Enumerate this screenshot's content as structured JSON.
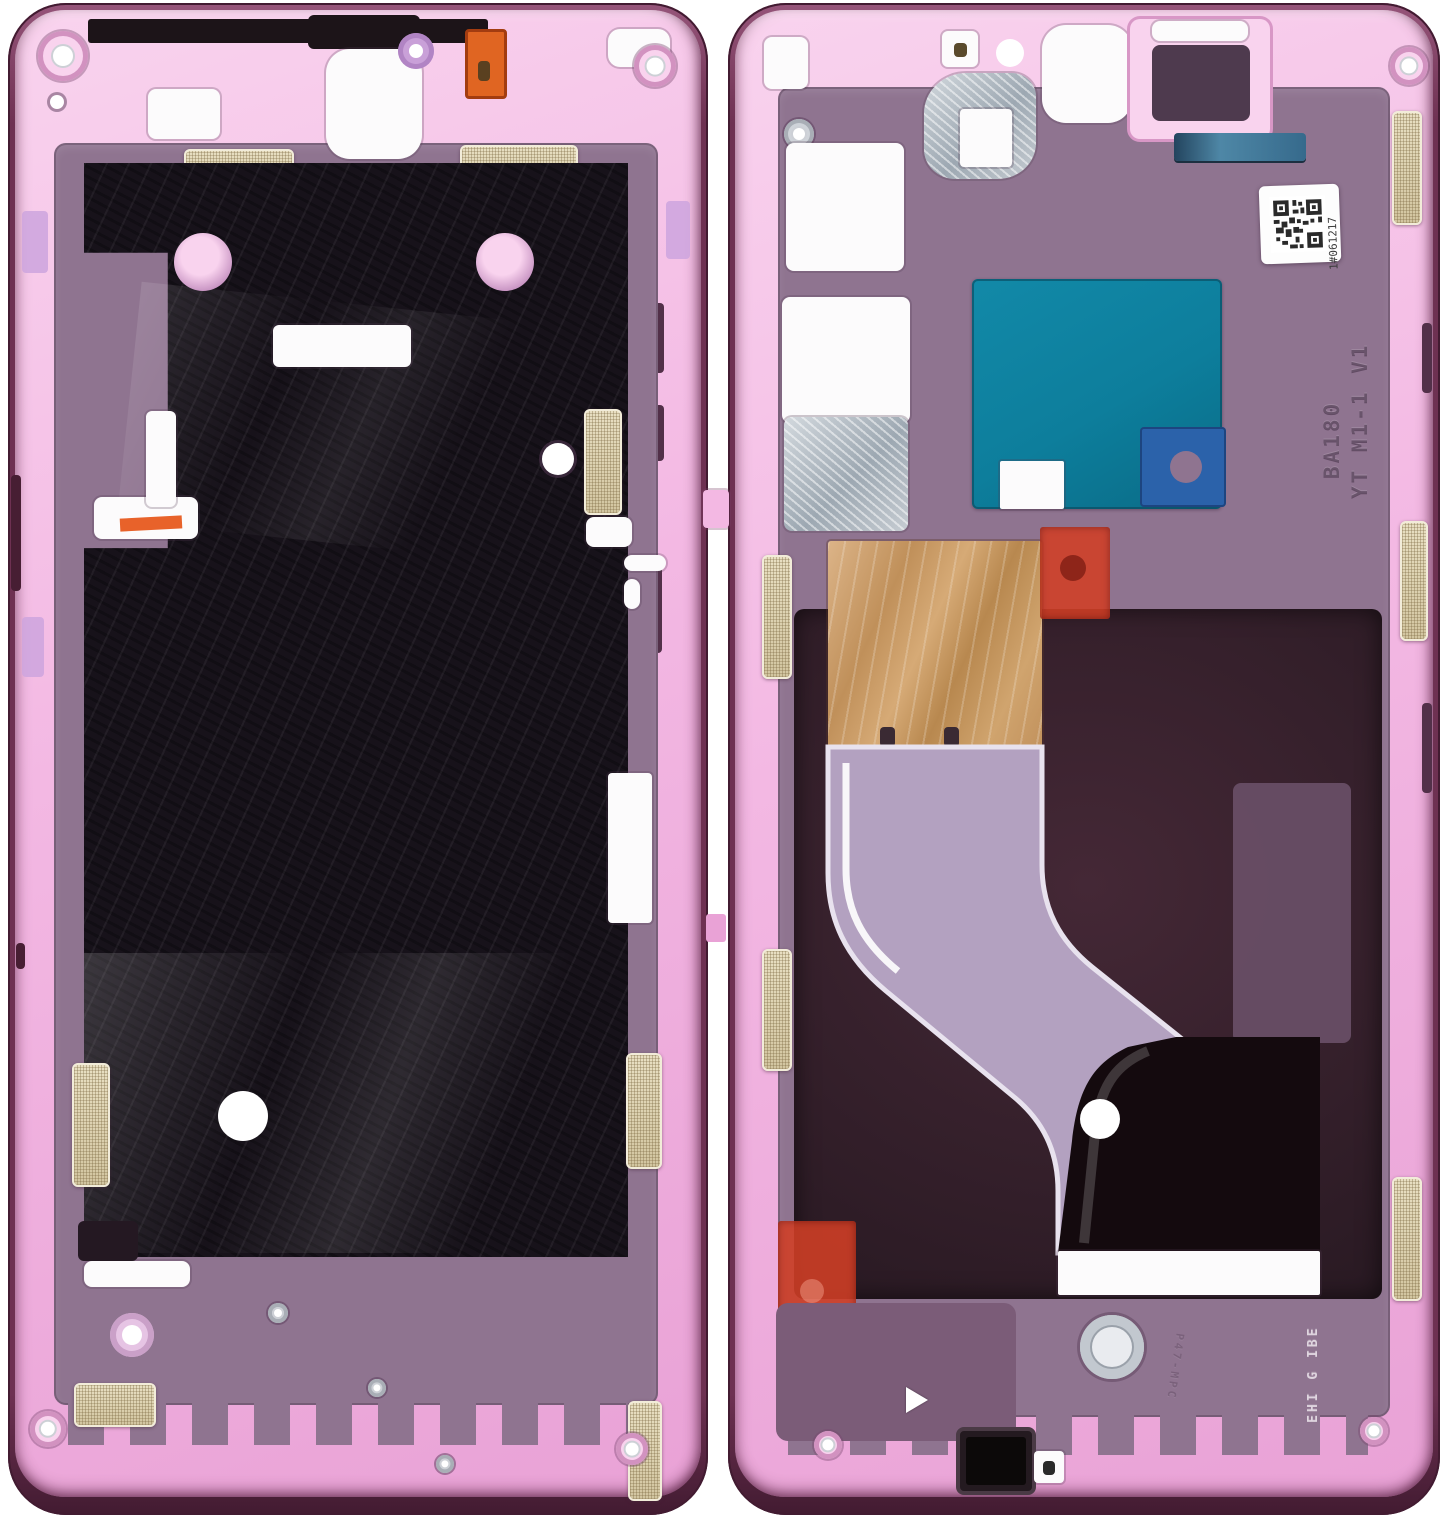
{
  "image_type": "product-photo",
  "subject": "smartphone middle frame, front and back views, pink",
  "texts": {
    "qr_serial": "1#061217",
    "molded_code_line1": "BA180",
    "molded_code_line2": "YT M1-1 V1",
    "molded_code_small": "P47-MPC",
    "molded_code_bottom": "EHI G IBE"
  },
  "palette": {
    "bg": "#ffffff",
    "edge": "#6e3152",
    "edge-hi": "#96557a",
    "edge-dk": "#421b31",
    "pink": "#f3b8e3",
    "pink-hi": "#f9d3ee",
    "pink-dp": "#e9a2d6",
    "plate": "#8f7490",
    "plate-dk": "#6b506a",
    "slot": "#523049",
    "lilac": "#cda5de",
    "black": "#17121a",
    "white": "#fcfbfc",
    "orange": "#e06522",
    "copper": "#c79a6a",
    "teal": "#0d7e9c",
    "blue": "#2b62aa",
    "steel": "#4e87a6",
    "red": "#d23f26",
    "flex": "#b3a1c0",
    "well": "#33212d",
    "silver": "#c9ccd2"
  }
}
